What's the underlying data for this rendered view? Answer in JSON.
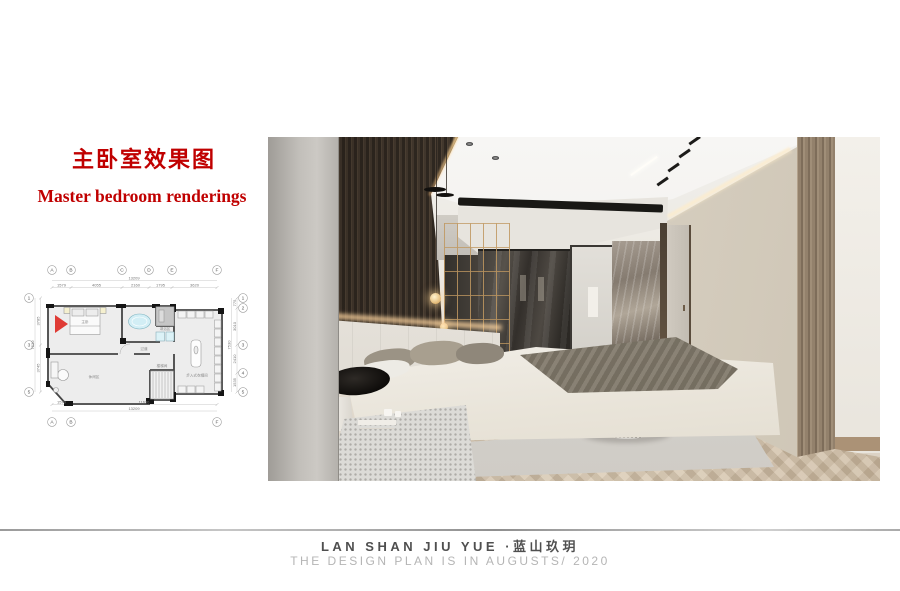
{
  "header": {
    "title_zh": "主卧室效果图",
    "title_en": "Master bedroom renderings",
    "accent_color": "#c00000"
  },
  "floor_plan": {
    "grid_top": [
      "A",
      "B",
      "C",
      "D",
      "E",
      "F"
    ],
    "grid_bottom": [
      "A",
      "B",
      "F"
    ],
    "grid_left": [
      "1",
      "3",
      "5"
    ],
    "grid_right": [
      "1",
      "2",
      "3",
      "4",
      "5"
    ],
    "dims_top": [
      "1579",
      "4055",
      "2160",
      "1795",
      "3620"
    ],
    "dim_top_total": "13209",
    "dims_bottom": [
      "1579",
      "11630"
    ],
    "dim_bottom_total": "13209",
    "dims_left": [
      "3785",
      "3745"
    ],
    "dim_left_total": "7530",
    "dims_right": [
      "775",
      "3010",
      "2410",
      "1535"
    ],
    "dim_right_total": "7530",
    "rooms": {
      "master": "主卧",
      "shower": "淋浴区",
      "corridor": "过道",
      "closet": "步入式衣帽间",
      "stairs": "楼梯间",
      "lounge": "休闲区"
    },
    "camera_marker_color": "#dd2b25"
  },
  "footer": {
    "brand": "LAN SHAN JIU YUE ·蓝山玖玥",
    "subtitle": "THE DESIGN PLAN IS IN AUGUSTS/ 2020",
    "brand_color": "#4f4f4f",
    "subtitle_color": "#b5b5b5"
  }
}
